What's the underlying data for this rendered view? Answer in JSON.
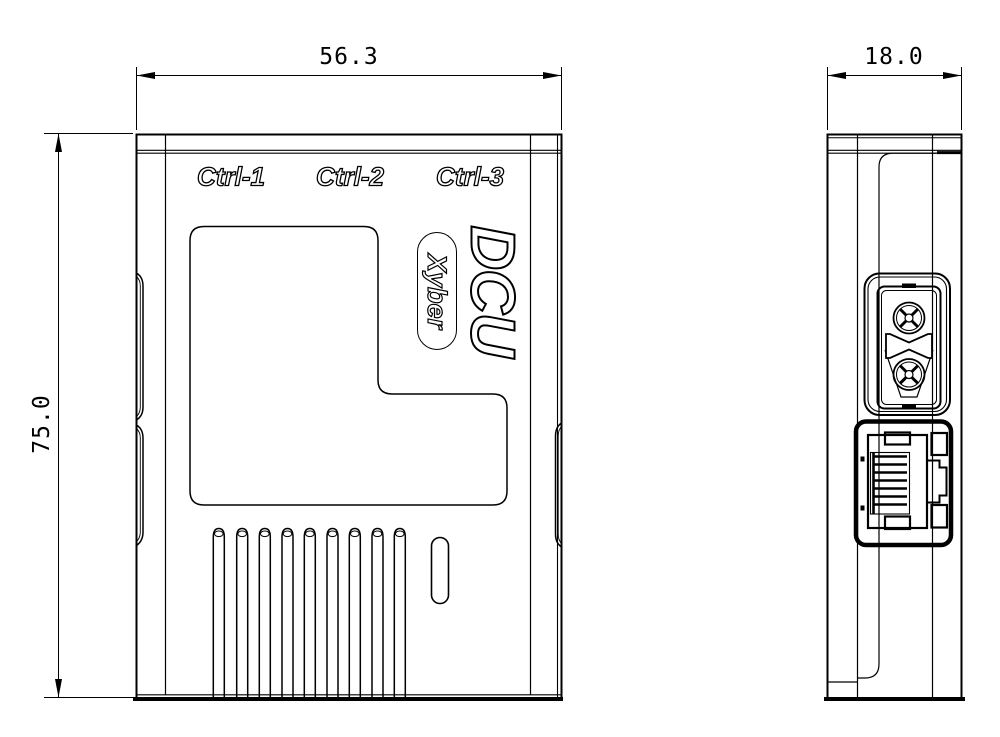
{
  "drawing": {
    "dimensions": {
      "front_width_mm": "56.3",
      "front_height_mm": "75.0",
      "side_depth_mm": "18.0"
    },
    "front_view": {
      "port_labels": [
        "Ctrl-1",
        "Ctrl-2",
        "Ctrl-3"
      ],
      "product_name": "DCU",
      "brand_badge": "Xyber",
      "vent_fin_count": 9,
      "features": [
        "vent-fins",
        "oval-slot",
        "left-side-rail",
        "right-side-rail",
        "recessed-panel"
      ]
    },
    "side_view": {
      "connectors": [
        "xt30-power-connector",
        "rj45-ethernet-port"
      ]
    },
    "style": {
      "line_color": "#000000",
      "background": "#ffffff"
    }
  }
}
